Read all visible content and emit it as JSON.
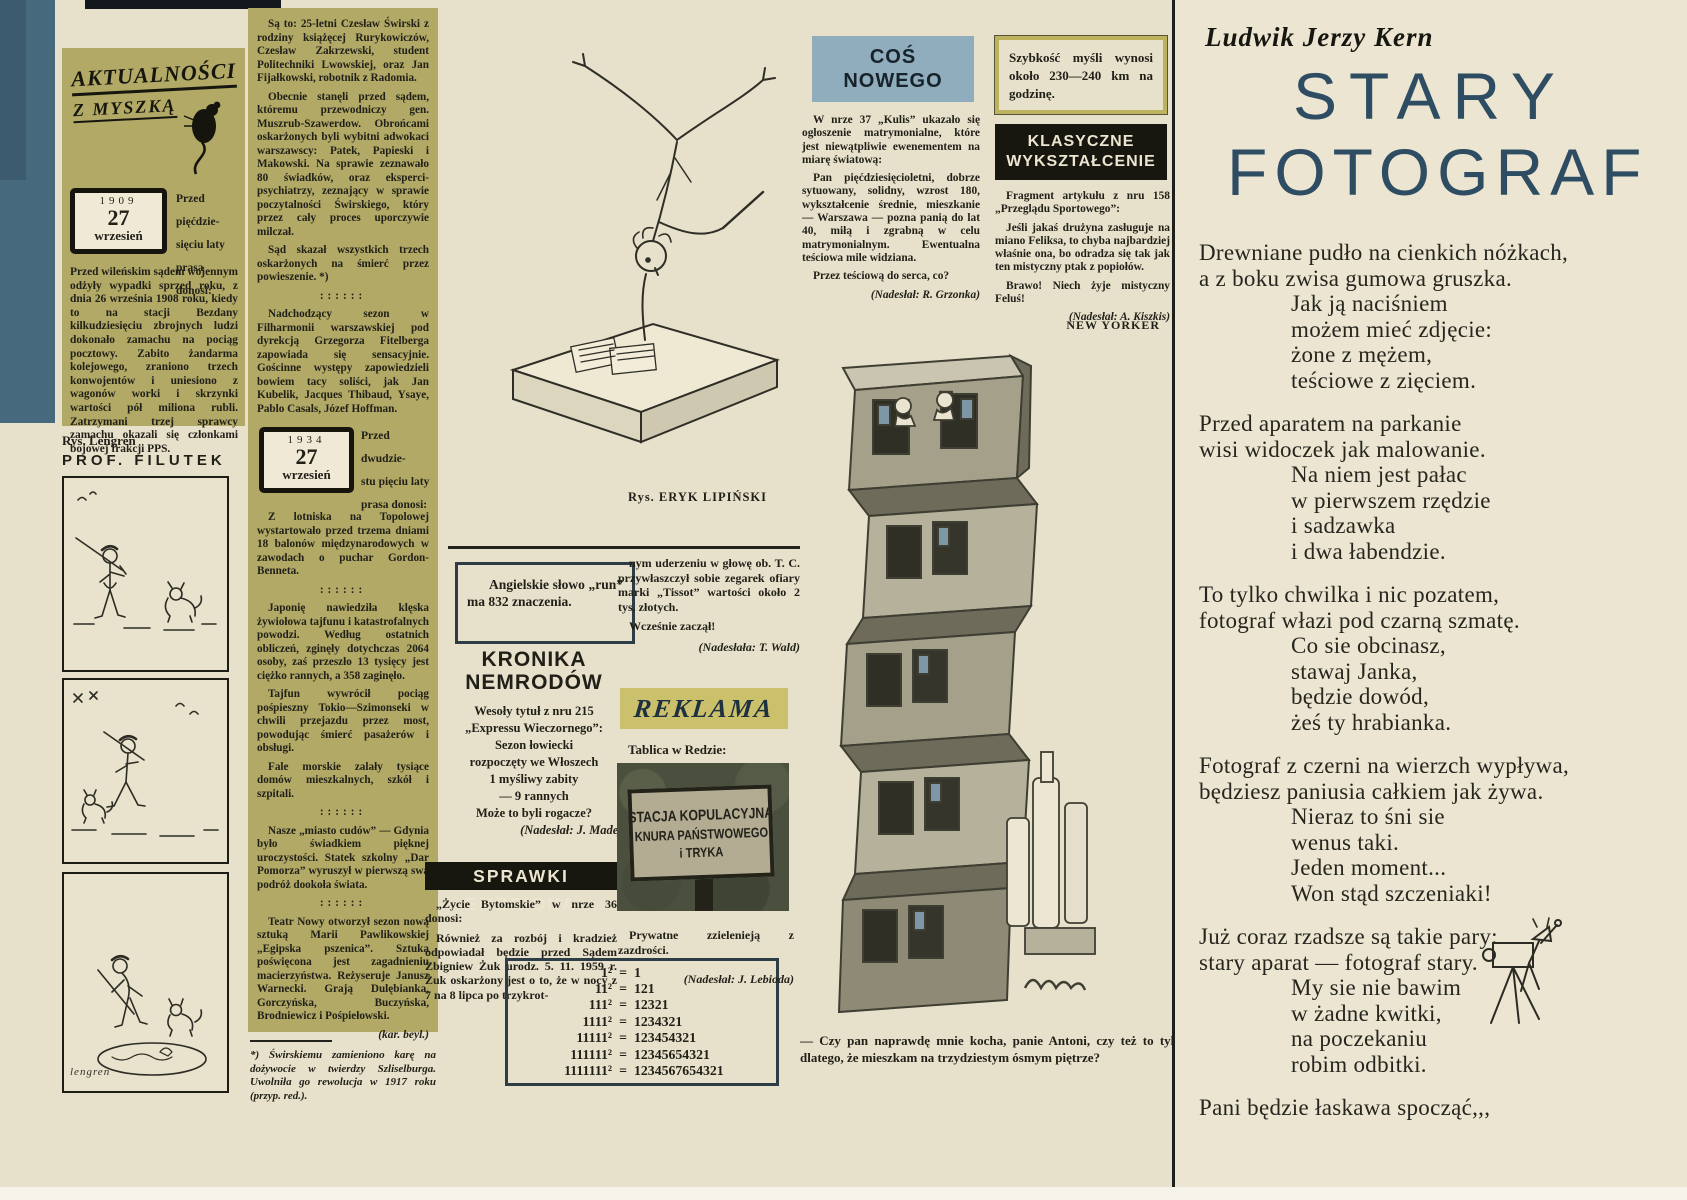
{
  "colors": {
    "page_cream": "#e7e0ca",
    "olive_panel": "#b1a965",
    "left_band_blue": "#47697d",
    "cos_header_blue": "#8fadbc",
    "reklama_band": "#cbc06c",
    "banner_black": "#17170f",
    "title_blue": "#2e4d63"
  },
  "masthead": {
    "line1": "AKTUALNOŚCI",
    "line2": "Z MYSZKĄ",
    "mouse_icon": "mouse-silhouette"
  },
  "col1": {
    "datebox": {
      "year": "1909",
      "day": "27",
      "month": "wrzesień"
    },
    "heading": "Przed pięćdzie-\nsięciu laty\nprasa donosi:",
    "body": "Przed wileńskim sądem wojennym odżyły wypadki sprzed roku, z dnia 26 września 1908 roku, kiedy to na stacji Bezdany kilkudziesięciu zbrojnych ludzi dokonało zamachu na pociąg pocztowy. Zabito żandarma kolejowego, zraniono trzech konwojentów i uniesiono z wagonów worki i skrzynki wartości pół miliona rubli. Zatrzymani trzej sprawcy zamachu okazali się członkami bojowej frakcji PPS.",
    "artist_credit": "Rys. Lengren",
    "comic_title": "PROF. FILUTEK",
    "comic_signature": "lengren"
  },
  "col2": {
    "paras_a": [
      {
        "text": "Są to: 25-letni Czesław Świrski z rodziny książęcej Rurykowiczów, Czesław Zakrzewski, student Politechniki Lwowskiej, oraz Jan Fijałkowski, robotnik z Radomia.",
        "cls": "p"
      },
      {
        "text": "Obecnie stanęli przed sądem, któremu przewodniczy gen. Muszrub-Szawerdow. Obrońcami oskarżonych byli wybitni adwokaci warszawscy: Patek, Papieski i Makowski. Na sprawie zeznawało 80 świadków, oraz eksperci-psychiatrzy, zeznający w sprawie poczytalności Świrskiego, który przez cały proces uporczywie milczał.",
        "cls": "p"
      },
      {
        "text": "Sąd skazał wszystkich trzech oskarżonych na śmierć przez powieszenie. *)",
        "cls": "p"
      },
      {
        "text": "::::::",
        "cls": "sep"
      },
      {
        "text": "Nadchodzący sezon w Filharmonii warszawskiej pod dyrekcją Grzegorza Fitelberga zapowiada się sensacyjnie. Gościnne występy zapowiedzieli bowiem tacy soliści, jak Jan Kubelik, Jacques Thibaud, Ysaye, Pablo Casals, Józef Hoffman.",
        "cls": "p"
      }
    ],
    "datebox": {
      "year": "1934",
      "day": "27",
      "month": "wrzesień"
    },
    "heading": "Przed dwudzie-\nstu pięciu laty\nprasa donosi:",
    "paras_b": [
      {
        "text": "Z lotniska na Topolowej wystartowało przed trzema dniami 18 balonów międzynarodowych w zawodach o puchar Gordon-Benneta.",
        "cls": "p"
      },
      {
        "text": "::::::",
        "cls": "sep"
      },
      {
        "text": "Japonię nawiedziła klęska żywiołowa tajfunu i katastrofalnych powodzi. Według ostatnich obliczeń, zginęły dotychczas 2064 osoby, zaś przeszło 13 tysięcy jest ciężko rannych, a 358 zaginęło.",
        "cls": "p"
      },
      {
        "text": "Tajfun wywrócił pociąg pośpieszny Tokio—Szimonseki w chwili przejazdu przez most, powodując śmierć pasażerów i obsługi.",
        "cls": "p"
      },
      {
        "text": "Fale morskie zalały tysiące domów mieszkalnych, szkół i szpitali.",
        "cls": "p"
      },
      {
        "text": "::::::",
        "cls": "sep"
      },
      {
        "text": "Nasze „miasto cudów” — Gdynia było świadkiem pięknej uroczystości. Statek szkolny „Dar Pomorza” wyruszył w pierwszą swą podróż dookoła świata.",
        "cls": "p"
      },
      {
        "text": "::::::",
        "cls": "sep"
      },
      {
        "text": "Teatr Nowy otworzył sezon nową sztuką Marii Pawlikowskiej „Egipska pszenica”. Sztuka poświęcona jest zagadnieniu macierzyństwa. Reżyseruje Janusz Warnecki. Grają Dulębianka, Gorczyńska, Buczyńska, Brodniewicz i Pośpiełowski.",
        "cls": "p"
      },
      {
        "text": "(kar. beyl.)",
        "cls": "credit"
      }
    ],
    "footnote": "*) Świrskiemu zamieniono karę na dożywocie w twierdzy Szliselburga. Uwolniła go rewolucja w 1917 roku (przyp. red.)."
  },
  "lipinski": {
    "credit": "Rys. ERYK LIPIŃSKI"
  },
  "run_box": {
    "text": "Angielskie słowo „run” ma 832 znaczenia."
  },
  "kronika": {
    "title1": "KRONIKA",
    "title2": "NEMRODÓW",
    "lines": [
      {
        "text": "Wesoły tytuł z nru 215",
        "cls": "c"
      },
      {
        "text": "„Expressu Wieczornego”:",
        "cls": "c"
      },
      {
        "text": "Sezon łowiecki",
        "cls": "c"
      },
      {
        "text": "rozpoczęty we Włoszech",
        "cls": "c"
      },
      {
        "text": "1 myśliwy zabity",
        "cls": "c"
      },
      {
        "text": "— 9 rannych",
        "cls": "c"
      },
      {
        "text": "Może to byli rogacze?",
        "cls": "c"
      },
      {
        "text": "(Nadesłał: J. Madej)",
        "cls": "credit"
      }
    ]
  },
  "sprawki": {
    "title": "SPRAWKI EMBRIONA",
    "paras": [
      {
        "text": "„Życie Bytomskie” w nrze 36 donosi:",
        "cls": "p"
      },
      {
        "text": "Również za rozbój i kradzież odpowiadał będzie przed Sądem Zbigniew Żuk urodz. 5. 11. 1959 r. Żuk oskarżony jest o to, że w nocy z 7 na 8 lipca po trzykrot-",
        "cls": "p"
      }
    ]
  },
  "continuation": {
    "paras": [
      {
        "text": "nym uderzeniu w głowę ob. T. C. przywłaszczył sobie zegarek ofiary marki „Tissot” wartości około 2 tys. złotych.",
        "cls": "p"
      },
      {
        "text": "Wcześnie zaczął!",
        "cls": "p"
      },
      {
        "text": "(Nadesłała: T. Wald)",
        "cls": "credit"
      }
    ]
  },
  "reklama": {
    "label": "REKLAMA",
    "intro": "Tablica w Redzie:",
    "sign_lines": [
      {
        "text": "STACJA KOPULACYJNA",
        "cls": "s1"
      },
      {
        "text": "KNURA PAŃSTWOWEGO",
        "cls": "s2"
      },
      {
        "text": "i TRYKA",
        "cls": "s3"
      }
    ],
    "after": "Prywatne zzielenieją z zazdrości.",
    "credit": "(Nadesłał: J. Lebioda)"
  },
  "math_box": {
    "rows": [
      {
        "lhs": "1²",
        "eq": "=",
        "rhs": "1"
      },
      {
        "lhs": "11²",
        "eq": "=",
        "rhs": "121"
      },
      {
        "lhs": "111²",
        "eq": "=",
        "rhs": "12321"
      },
      {
        "lhs": "1111²",
        "eq": "=",
        "rhs": "1234321"
      },
      {
        "lhs": "11111²",
        "eq": "=",
        "rhs": "123454321"
      },
      {
        "lhs": "111111²",
        "eq": "=",
        "rhs": "12345654321"
      },
      {
        "lhs": "1111111²",
        "eq": "=",
        "rhs": "1234567654321"
      }
    ]
  },
  "cos_nowego": {
    "title1": "COŚ",
    "title2": "NOWEGO",
    "paras": [
      {
        "text": "W nrze 37 „Kulis” ukazało się ogłoszenie matrymonialne, które jest niewątpliwie ewenementem na miarę światową:",
        "cls": "p"
      },
      {
        "text": "Pan pięćdziesięcioletni, dobrze sytuowany, solidny, wzrost 180, wykształcenie średnie, mieszkanie — Warszawa — pozna panią do lat 40, miłą i zgrabną w celu matrymonialnym. Ewentualna teściowa mile widziana.",
        "cls": "p"
      },
      {
        "text": "Przez teściową do serca, co?",
        "cls": "p"
      },
      {
        "text": "(Nadesłał: R. Grzonka)",
        "cls": "credit"
      }
    ]
  },
  "new_yorker": {
    "label": "NEW YORKER",
    "caption": "— Czy pan naprawdę mnie kocha, panie Antoni, czy też to tylko dlatego, że mieszkam na trzydziestym ósmym piętrze?"
  },
  "szybkosc": {
    "text": "Szybkość myśli wynosi około 230—240 km na godzinę."
  },
  "klasyczne": {
    "title1": "KLASYCZNE",
    "title2": "WYKSZTAŁCENIE",
    "paras": [
      {
        "text": "Fragment artykułu z nru 158 „Przeglądu Sportowego”:",
        "cls": "p"
      },
      {
        "text": "Jeśli jakaś drużyna zasługuje na miano Feliksa, to chyba najbardziej właśnie ona, bo odradza się tak jak ten mistyczny ptak z popiołów.",
        "cls": "p"
      },
      {
        "text": "Brawo! Niech żyje mistyczny Feluś!",
        "cls": "p"
      },
      {
        "text": "(Nadesłał: A. Kiszkis)",
        "cls": "credit"
      }
    ]
  },
  "poem": {
    "author": "Ludwik Jerzy Kern",
    "title1": "STARY",
    "title2": "FOTOGRAF",
    "lines": [
      {
        "t": "Drewniane pudło na cienkich nóżkach,",
        "cls": "flush"
      },
      {
        "t": "a z boku zwisa gumowa gruszka.",
        "cls": "flush"
      },
      {
        "t": "Jak ją naciśniem",
        "cls": "ind"
      },
      {
        "t": "możem mieć zdjęcie:",
        "cls": "ind"
      },
      {
        "t": "żone z mężem,",
        "cls": "ind"
      },
      {
        "t": "teściowe z zięciem.",
        "cls": "ind"
      },
      {
        "t": "Przed aparatem na parkanie",
        "cls": "gap"
      },
      {
        "t": "wisi widoczek jak malowanie.",
        "cls": "flush"
      },
      {
        "t": "Na niem jest pałac",
        "cls": "ind"
      },
      {
        "t": "w pierwszem rzędzie",
        "cls": "ind"
      },
      {
        "t": "i sadzawka",
        "cls": "ind"
      },
      {
        "t": "i dwa łabendzie.",
        "cls": "ind"
      },
      {
        "t": "To tylko chwilka i nic pozatem,",
        "cls": "gap"
      },
      {
        "t": "fotograf włazi pod czarną szmatę.",
        "cls": "flush"
      },
      {
        "t": "Co sie obcinasz,",
        "cls": "ind"
      },
      {
        "t": "stawaj Janka,",
        "cls": "ind"
      },
      {
        "t": "będzie dowód,",
        "cls": "ind"
      },
      {
        "t": "żeś ty hrabianka.",
        "cls": "ind"
      },
      {
        "t": "Fotograf z czerni na wierzch wypływa,",
        "cls": "gap"
      },
      {
        "t": "będziesz paniusia całkiem jak żywa.",
        "cls": "flush"
      },
      {
        "t": "Nieraz to śni sie",
        "cls": "ind"
      },
      {
        "t": "wenus taki.",
        "cls": "ind"
      },
      {
        "t": "Jeden moment...",
        "cls": "ind"
      },
      {
        "t": "Won stąd szczeniaki!",
        "cls": "ind"
      },
      {
        "t": "Już coraz rzadsze są takie pary:",
        "cls": "gap"
      },
      {
        "t": "stary aparat — fotograf stary.",
        "cls": "flush"
      },
      {
        "t": "My sie nie bawim",
        "cls": "ind"
      },
      {
        "t": "w żadne kwitki,",
        "cls": "ind"
      },
      {
        "t": "na poczekaniu",
        "cls": "ind"
      },
      {
        "t": "robim odbitki.",
        "cls": "ind"
      },
      {
        "t": "Pani będzie łaskawa spocząć,,,",
        "cls": "gap"
      }
    ]
  }
}
